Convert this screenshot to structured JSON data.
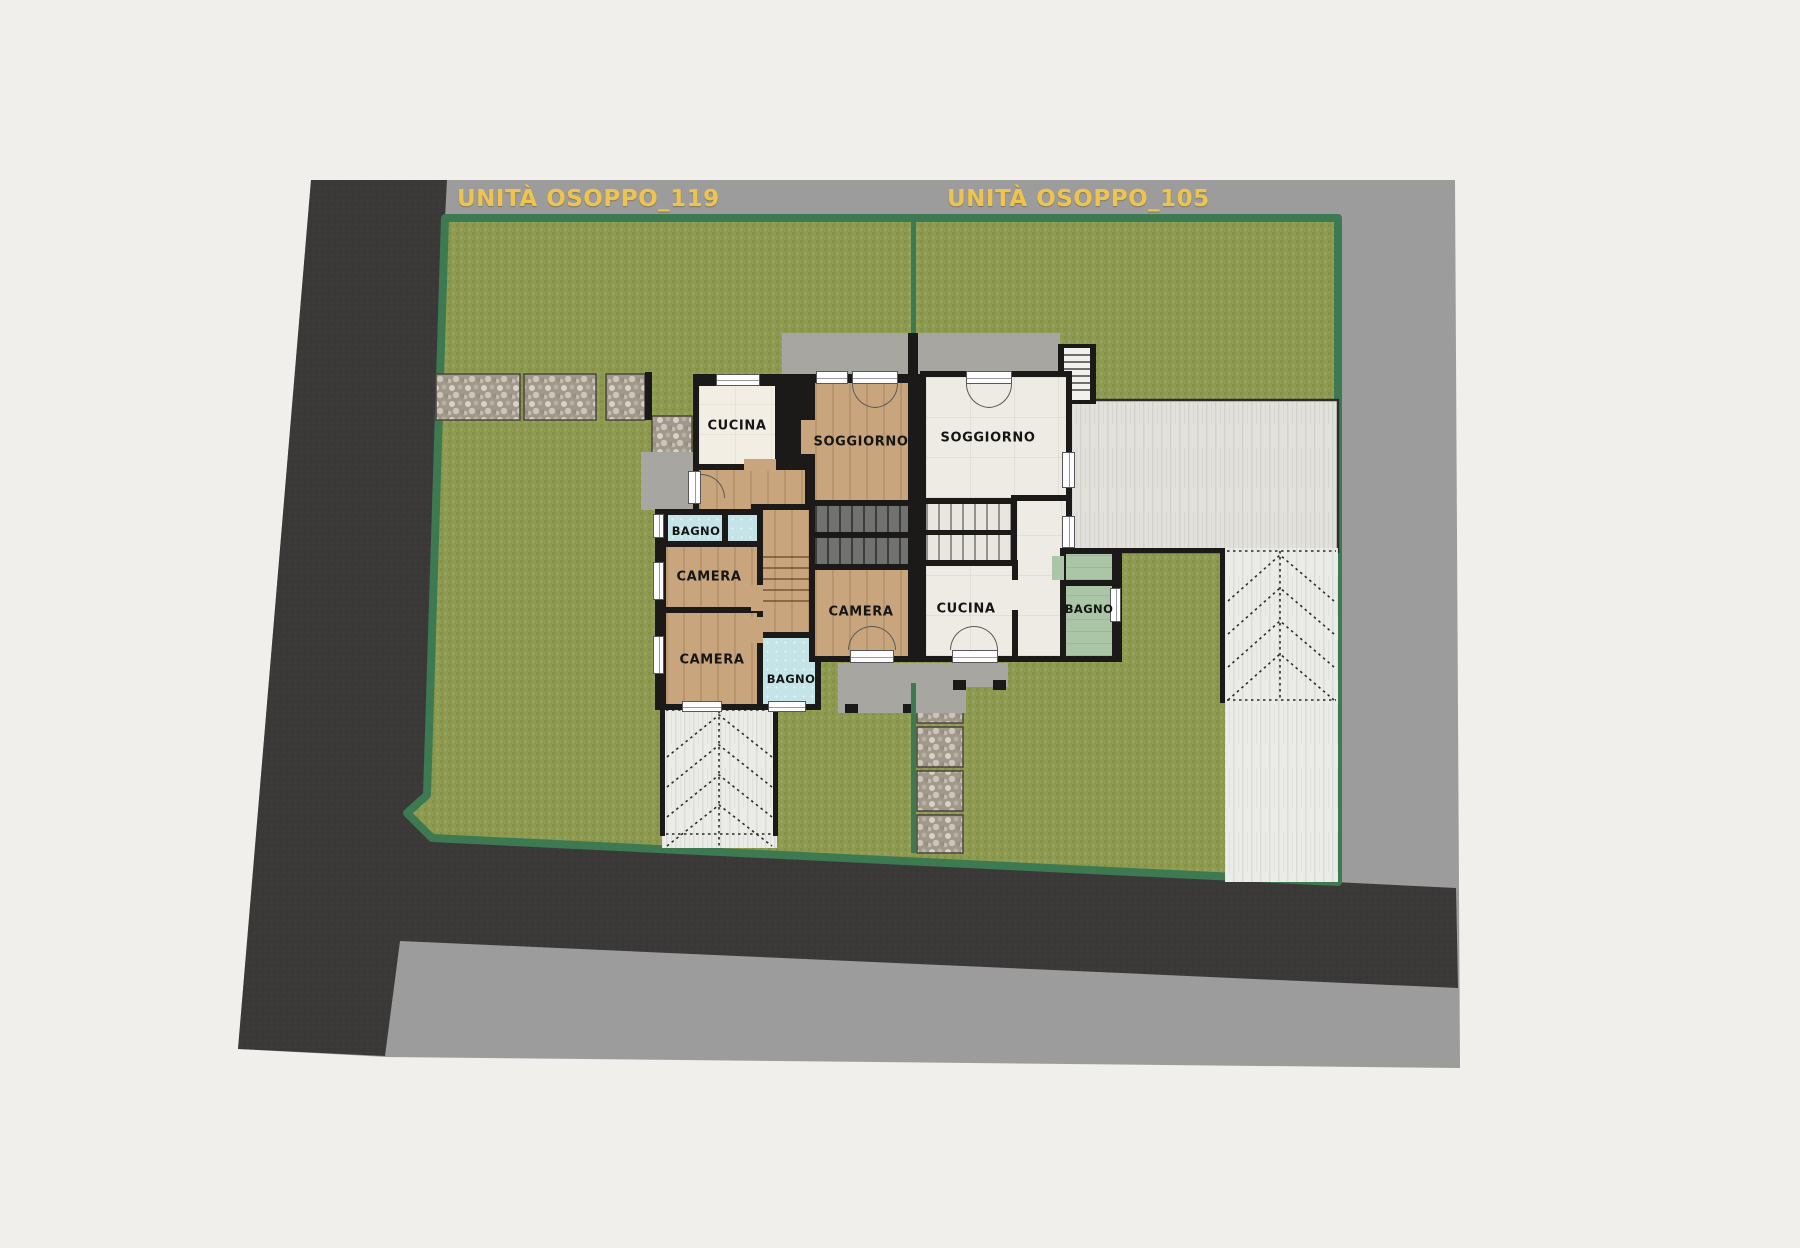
{
  "plan": {
    "type": "architectural floor plan - ground floor site plan, two semi-detached units",
    "unit_titles": {
      "unit_119": "UNITÀ OSOPPO_119",
      "unit_105": "UNITÀ OSOPPO_105"
    },
    "rooms": {
      "cucina_119": "CUCINA",
      "soggiorno_119": "SOGGIORNO",
      "bagno_119": "BAGNO",
      "camera_119_a": "CAMERA",
      "camera_119_b": "CAMERA",
      "bagno_119_b": "BAGNO",
      "camera_119_c": "CAMERA",
      "soggiorno_105": "SOGGIORNO",
      "cucina_105": "CUCINA",
      "bagno_105": "BAGNO"
    },
    "colors": {
      "page_background": "#f0efec",
      "title_text": "#eec44e",
      "title_band": "#9c9c9c",
      "asphalt_road": "#3b3938",
      "pavement_gray": "#9c9c9c",
      "grass": "#8d9a50",
      "site_border_green": "#3d7a51",
      "terrace_concrete": "#e2e1dc",
      "driveway": "#ebebe7",
      "concrete_pad": "#a8a6a1",
      "wall_black": "#1b1a18",
      "wood_floor": "#c9a57e",
      "cream_floor": "#f3eee3",
      "tile_floor": "#edebe4",
      "bath_blue": "#c5e4e8",
      "bath_green": "#abc5a7"
    }
  }
}
